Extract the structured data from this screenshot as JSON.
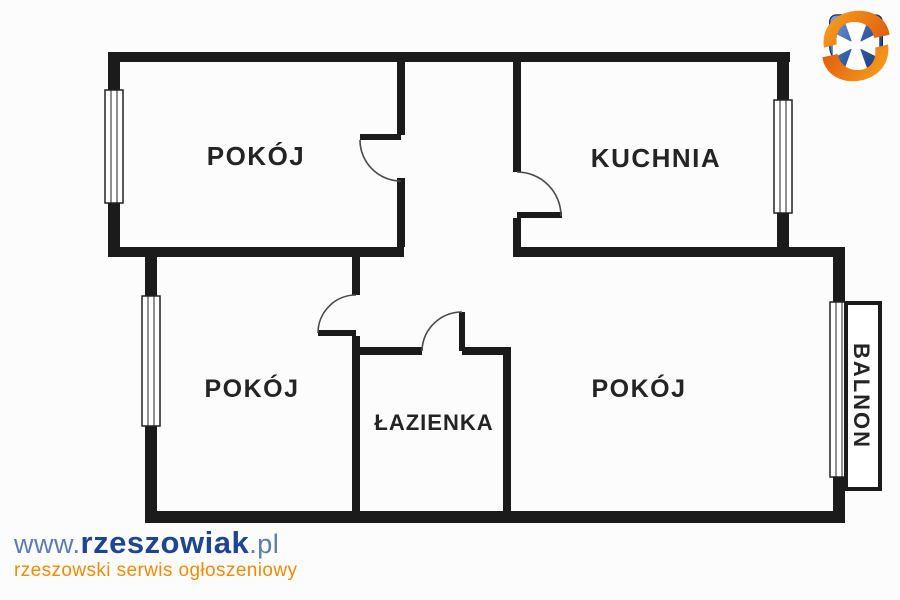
{
  "image": {
    "background": "#fcfcfc",
    "wall_color": "#1b1b1b"
  },
  "floor_plan": {
    "rooms": {
      "room_top_left": "POKÓJ",
      "kitchen": "KUCHNIA",
      "room_bottom_left": "POKÓJ",
      "bathroom": "ŁAZIENKA",
      "room_bottom_right": "POKÓJ",
      "balcony": "BALNON"
    }
  },
  "watermark": {
    "url_prefix": "www.",
    "url_name": "rzeszowiak",
    "url_suffix": ".pl",
    "tagline": "rzeszowski serwis ogłoszeniowy",
    "colors": {
      "url_accent": "#5b7cb0",
      "url_name": "#1f4490",
      "tagline": "#f18a05"
    }
  },
  "logo": {
    "icon": "rzeszow-crest-logo",
    "colors": {
      "shield": "#2b4f97",
      "cross": "#ffffff",
      "swirl": "#ef8212"
    }
  }
}
